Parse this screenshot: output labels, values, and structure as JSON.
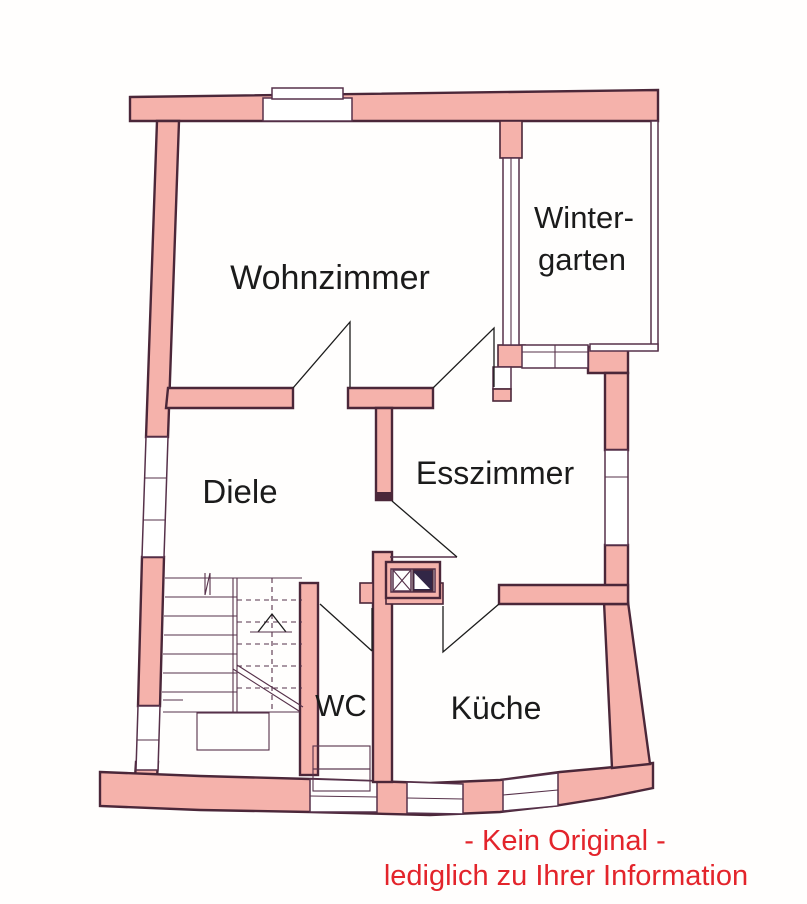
{
  "colors": {
    "wall_fill": "#f5b2ab",
    "wall_outline": "#4b2739",
    "line_color": "#56314a",
    "shaft_dark": "#322646",
    "label_color": "#1b1b1b",
    "disclaimer_color": "#e3242b"
  },
  "rooms": {
    "wohnzimmer": {
      "label": "Wohnzimmer"
    },
    "wintergarten": {
      "label_line1": "Winter-",
      "label_line2": "garten"
    },
    "esszimmer": {
      "label": "Esszimmer"
    },
    "diele": {
      "label": "Diele"
    },
    "wc": {
      "label": "WC"
    },
    "kueche": {
      "label": "Küche"
    }
  },
  "disclaimer": {
    "line1": "- Kein Original -",
    "line2": "lediglich zu Ihrer Information"
  }
}
